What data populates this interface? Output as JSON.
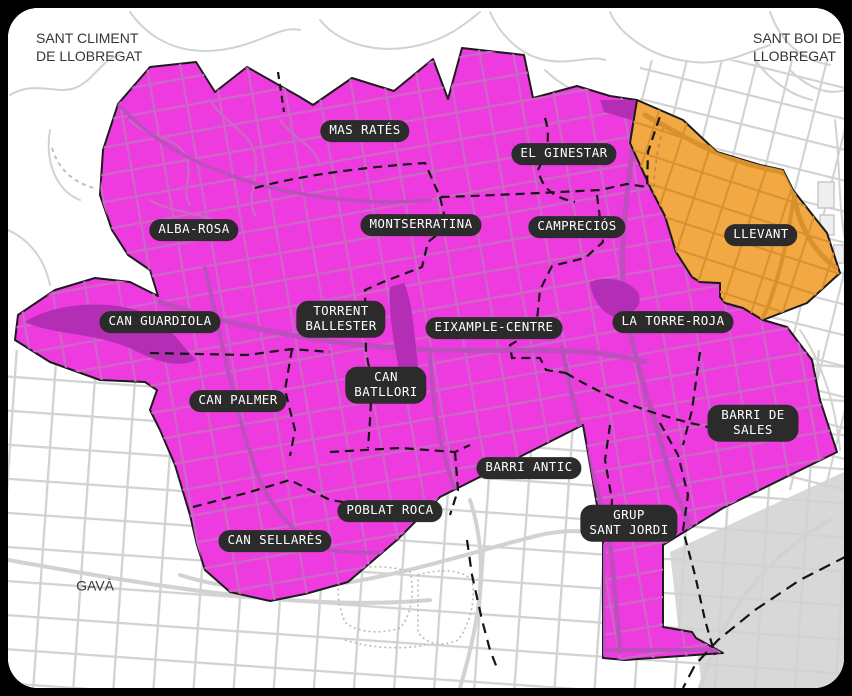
{
  "map": {
    "highlighted_neighborhood": "LLEVANT",
    "external_labels": [
      {
        "id": "sant-climent",
        "text": "SANT CLIMENT\nDE LLOBREGAT"
      },
      {
        "id": "sant-boi",
        "text": "SANT BOI DE\nLLOBREGAT"
      },
      {
        "id": "gava",
        "text": "GAVÀ"
      }
    ],
    "neighborhoods": [
      {
        "name": "MAS RATÉS"
      },
      {
        "name": "EL GINESTAR"
      },
      {
        "name": "ALBA-ROSA"
      },
      {
        "name": "MONTSERRATINA"
      },
      {
        "name": "CAMPRECIÓS"
      },
      {
        "name": "LLEVANT"
      },
      {
        "name": "CAN GUARDIOLA"
      },
      {
        "name": "TORRENT\nBALLESTER"
      },
      {
        "name": "EIXAMPLE-CENTRE"
      },
      {
        "name": "LA TORRE-ROJA"
      },
      {
        "name": "CAN PALMER"
      },
      {
        "name": "CAN\nBATLLORI"
      },
      {
        "name": "BARRI DE SALES"
      },
      {
        "name": "BARRI ANTIC"
      },
      {
        "name": "POBLAT ROCA"
      },
      {
        "name": "GRUP\nSANT JORDI"
      },
      {
        "name": "CAN SELLARÈS"
      }
    ],
    "colors": {
      "municipality_fill": "#ED3BE0",
      "municipality_roads": "#CC67C6",
      "municipality_major_roads": "#BC4FBD",
      "highlight_fill": "#F2A843",
      "highlight_roads": "#D8912C",
      "park_fill": "#B32DB5",
      "outside_roads": "#D2D2D2",
      "outside_area": "#D8D8D8",
      "label_pill_bg": "#2B2B2B",
      "label_pill_text": "#FFFFFF",
      "boundary_dash": "#141414",
      "frame": "#000000",
      "map_bg": "#FFFFFF"
    }
  }
}
